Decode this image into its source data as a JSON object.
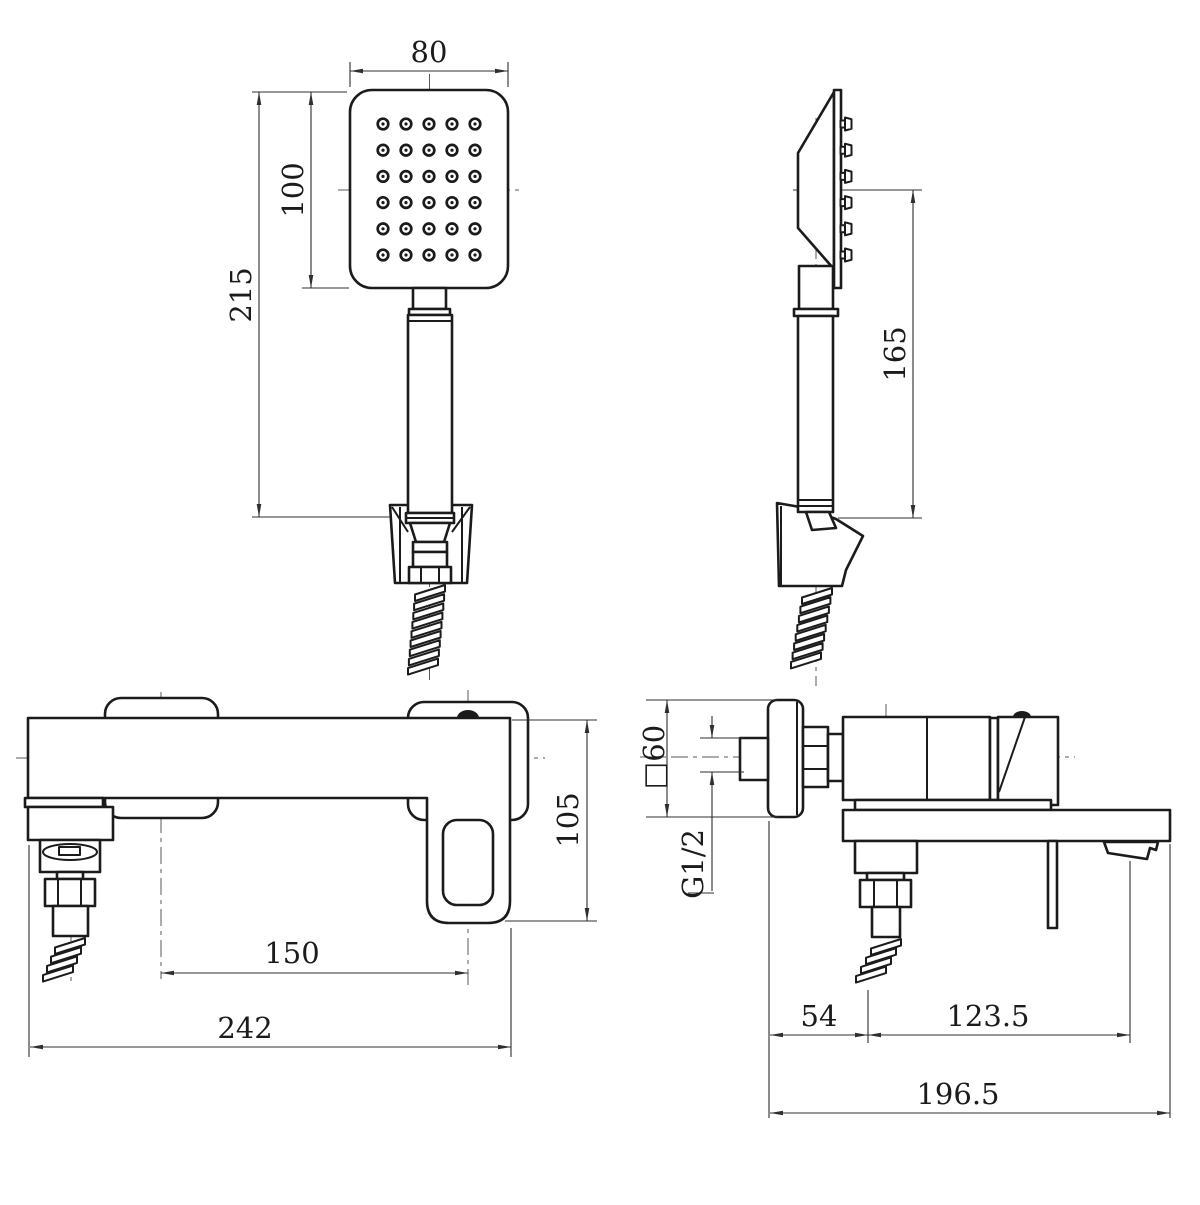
{
  "drawing": {
    "background": "#ffffff",
    "line_color": "#1b1b1b",
    "style": "black-and-white orthographic technical drawing, four views"
  },
  "handshower": {
    "nozzle_rows": 6,
    "nozzle_cols": 5,
    "side_nozzle_count": 6
  },
  "dims": {
    "head_width": "80",
    "head_face_height": "100",
    "handshower_length": "215",
    "hang_height": "165",
    "body_height": "105",
    "mounting_centers": "150",
    "body_width": "242",
    "flange_size": "□60",
    "connection_thread": "G1/2",
    "outlet_offset": "54",
    "spout_offset": "123.5",
    "overall_depth": "196.5"
  }
}
